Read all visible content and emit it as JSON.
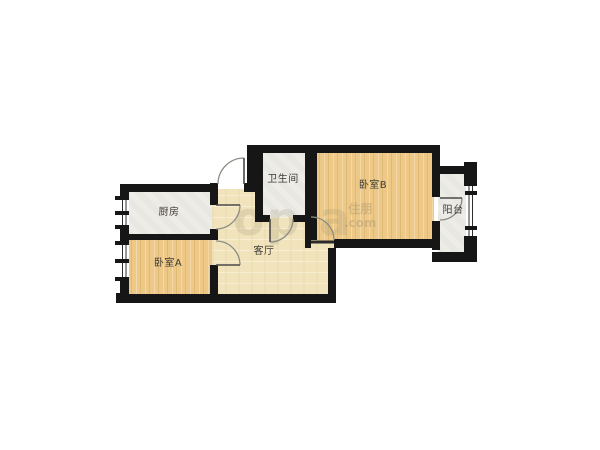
{
  "rooms": {
    "kitchen": {
      "label": "厨房"
    },
    "bedroom_a": {
      "label": "卧室A"
    },
    "living": {
      "label": "客厅"
    },
    "bathroom": {
      "label": "卫生间"
    },
    "bedroom_b": {
      "label": "卧室B"
    },
    "balcony": {
      "label": "阳台"
    }
  },
  "watermark": {
    "big": "opla",
    "cn": "住朋",
    "domain": ".com"
  },
  "colors": {
    "wall": "#161616",
    "bedroom_wood": "#edc886",
    "living_parquet": "#f1e4bd",
    "tile_floor": "#edece6",
    "door_arc": "#8d8d86",
    "background": "#ffffff"
  }
}
